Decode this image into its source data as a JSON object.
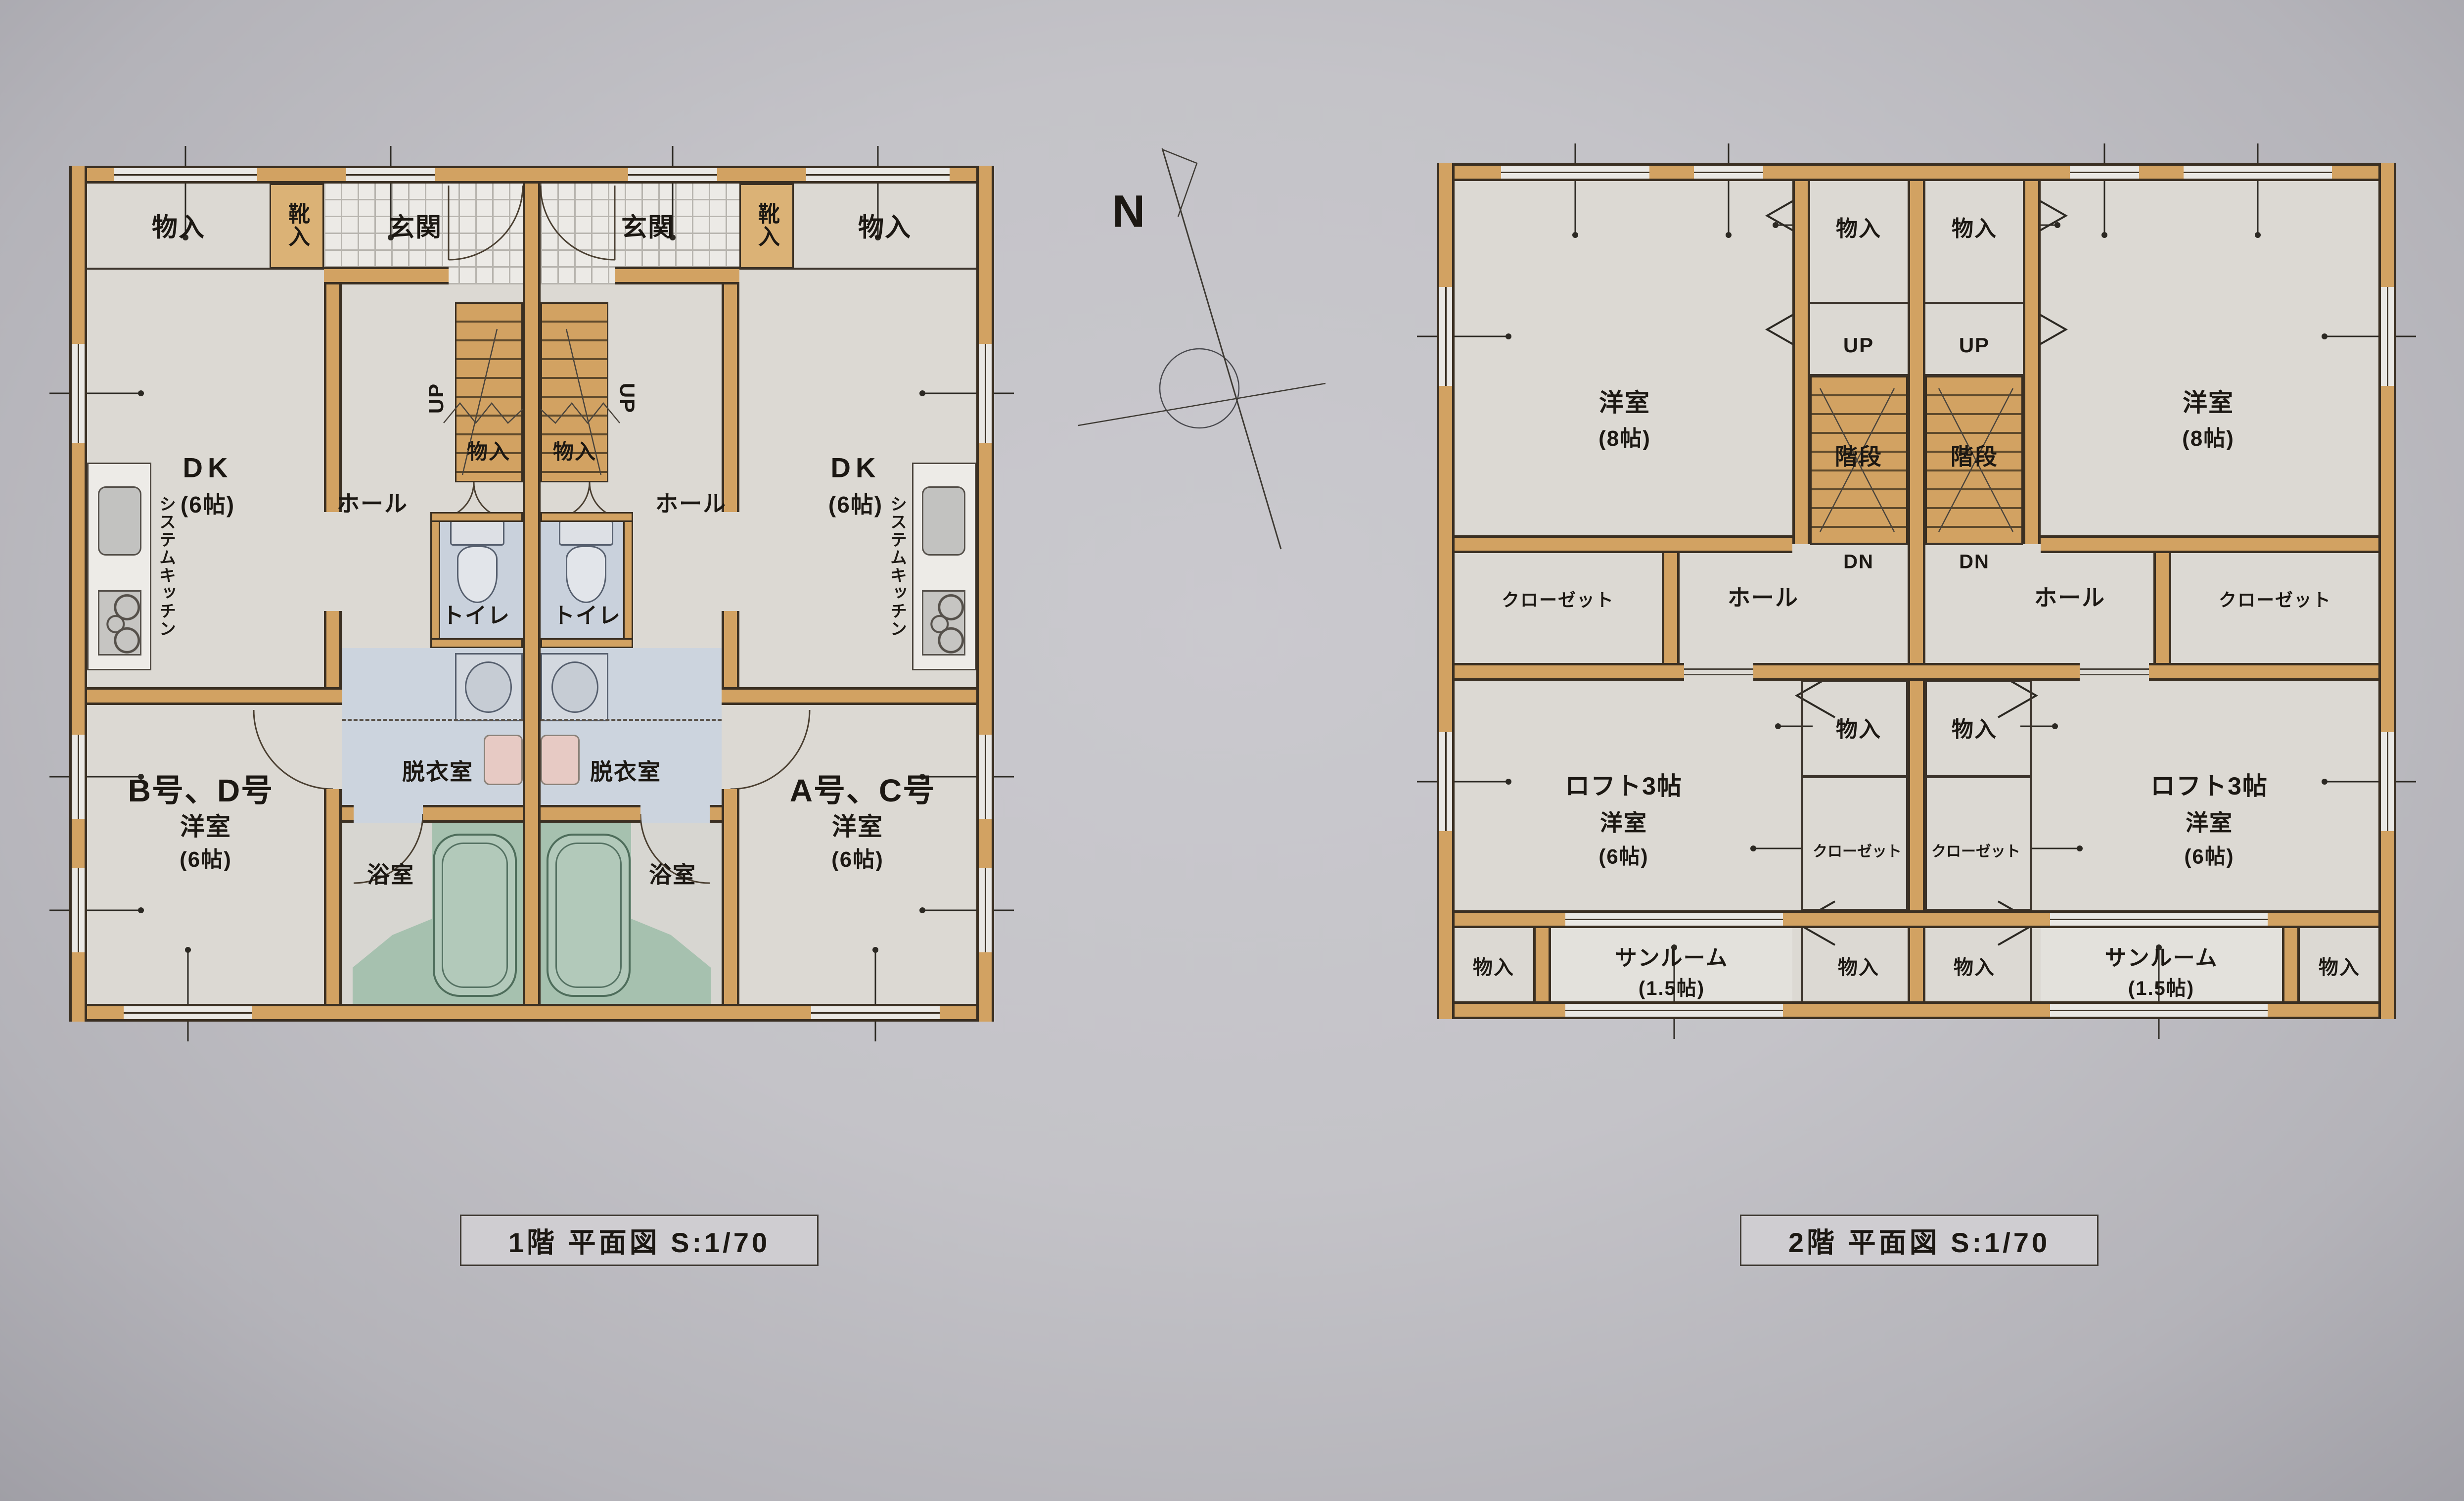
{
  "colors": {
    "paper": "#c4c3c8",
    "wall_fill": "#d2a262",
    "wall_line": "#3a2f22",
    "floor_light": "#dcd9d3",
    "wet_floor_blue": "#c9d1dc",
    "bath_green": "#a6c1af",
    "washer_pink": "#e7cac4",
    "label_ink": "#1c1813"
  },
  "compass": {
    "label": "N"
  },
  "floor1": {
    "caption": "1階  平面図 S:1/70",
    "unit_left": "B号、D号",
    "unit_right": "A号、C号",
    "labels": {
      "storage": "物入",
      "shoe_box": "靴入",
      "entrance": "玄関",
      "dk": "DK",
      "size_6": "(6帖)",
      "system_kitchen": "システムキッチン",
      "hall": "ホール",
      "up": "UP",
      "toilet": "トイレ",
      "dressing_room": "脱衣室",
      "bath": "浴室",
      "western_room": "洋室"
    }
  },
  "floor2": {
    "caption": "2階  平面図 S:1/70",
    "labels": {
      "western_room": "洋室",
      "size_8": "(8帖)",
      "size_6": "(6帖)",
      "storage": "物入",
      "up": "UP",
      "stairs": "階段",
      "down": "DN",
      "hall": "ホール",
      "closet": "クローゼット",
      "loft": "ロフト3帖",
      "sunroom": "サンルーム",
      "size_1_5": "(1.5帖)"
    }
  }
}
